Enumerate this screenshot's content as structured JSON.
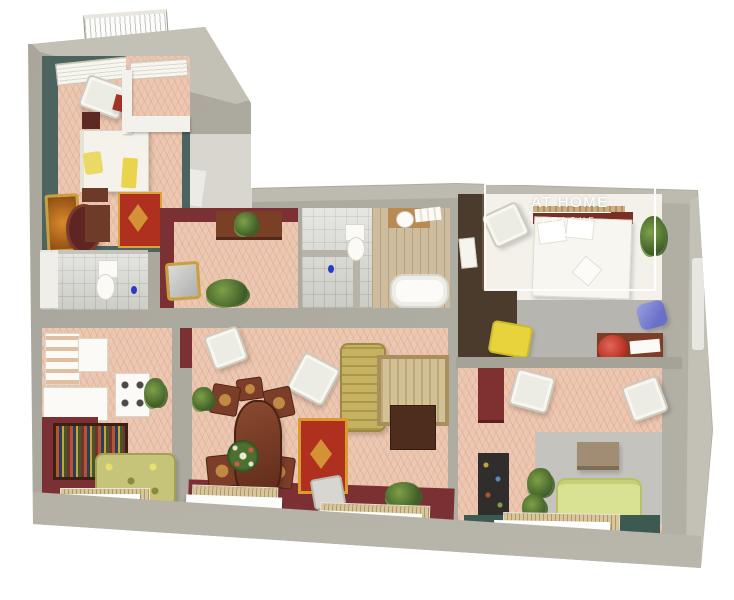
{
  "scene": {
    "type": "3d-cutaway-floorplan-render",
    "description": "Bird's-eye 3D render of an L-shaped apartment with cut-away grey walls on a white background",
    "background": "#ffffff"
  },
  "watermark": {
    "title": "AT HOME",
    "subtitle": "PRAGUE"
  },
  "palette": {
    "wallGray": "#a9a69c",
    "wallGrayLight": "#c3c0b6",
    "wallGrayDark": "#8e8b81",
    "wallBand": "#a5a197",
    "maroon": "#7b3134",
    "maroonDark": "#5f2326",
    "floorPink": "#ecc7b1",
    "tealWall": "#4d6360",
    "tealFloor": "#3c5a52",
    "marble": "#d9d9d3",
    "woodFloor": "#cdbd9e",
    "woodDark": "#5c3322",
    "mahogany": "#7c3e28",
    "woodSlat": "#cdb88c",
    "redRug": "#b03020",
    "rugGold": "#dba23a",
    "beigeRug": "#d3c196",
    "goldSofa": "#c7b262",
    "greenSofa": "#d9e192",
    "floralSofa": "#c6c478",
    "yellowChair": "#e7d33c",
    "blueChair": "#6a70c8",
    "plantDark": "#3f5f28",
    "plantLight": "#7fa048",
    "grayPanel": "#c5c3be",
    "grayFloor": "#b7b5b0",
    "blackShelf": "#2f2e2c",
    "taupeBox": "#a18d73",
    "cream": "#f3f1ea",
    "white": "#ffffff",
    "pinkFlower": "#d98ca4",
    "redFlower": "#c0392b",
    "blueAccent": "#2b3bbf",
    "darkOlive": "#4a3b2d"
  },
  "rooms": [
    {
      "id": "balcony",
      "features": [
        "white-lattice-railing"
      ]
    },
    {
      "id": "tower-bedroom",
      "features": [
        "teal-walls",
        "single-bed",
        "yellow-pillows",
        "oriental-red-rug",
        "cream-armchair",
        "dark-wood-dressers",
        "ornate-frame"
      ]
    },
    {
      "id": "tower-bathroom",
      "features": [
        "marble-tiles",
        "toilet"
      ]
    },
    {
      "id": "hallway",
      "features": [
        "maroon-walls",
        "wood-dresser",
        "ornate-mirror",
        "plants",
        "parquet-floor"
      ]
    },
    {
      "id": "bathroom",
      "features": [
        "marble-tiles",
        "toilet",
        "sink-counter",
        "bathtub"
      ]
    },
    {
      "id": "master-bedroom",
      "features": [
        "double-bed",
        "headboard-shelf",
        "plant",
        "white-armchair",
        "yellow-armchair",
        "blue-chair",
        "desk-with-red-flowers",
        "pink-flowers"
      ]
    },
    {
      "id": "kitchen",
      "features": [
        "white-cabinets",
        "gas-stove",
        "bookshelf",
        "floral-sofa",
        "maroon-wall"
      ]
    },
    {
      "id": "living-dining-room",
      "features": [
        "oval-dining-table",
        "dining-chairs",
        "wreath-centerpiece",
        "red-oriental-rug",
        "beige-rug",
        "gold-floral-sofa",
        "tv-stand",
        "white-armchairs",
        "plants",
        "window-radiators"
      ]
    },
    {
      "id": "lounge",
      "features": [
        "green-sofa",
        "white-armchairs",
        "black-shelf-unit",
        "wall-panel",
        "taupe-box",
        "plants",
        "teal-floor-strip"
      ]
    }
  ]
}
